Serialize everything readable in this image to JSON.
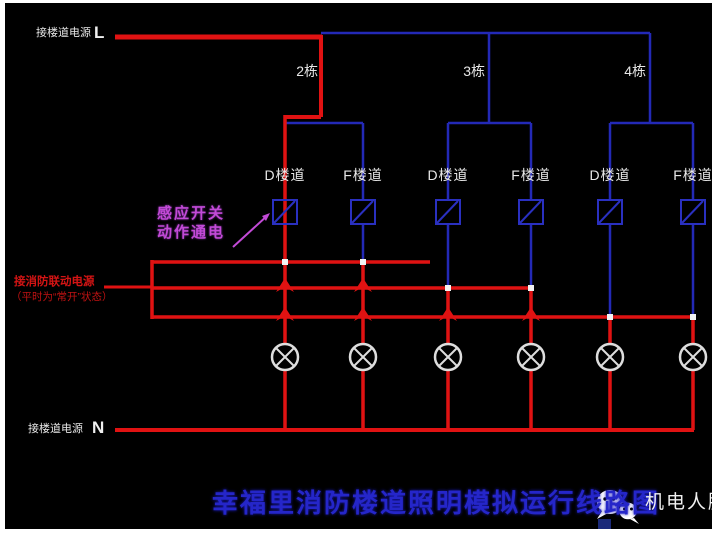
{
  "labels": {
    "top_supply": "接楼道电源",
    "live": "L",
    "neutral": "N",
    "bottom_supply": "接楼道电源",
    "buildings": [
      "2栋",
      "3栋",
      "4栋"
    ],
    "corridors": [
      "D楼道",
      "F楼道",
      "D楼道",
      "F楼道",
      "D楼道",
      "F楼道"
    ],
    "sensor_note": [
      "感应开关",
      "动作通电"
    ],
    "fire_supply": [
      "接消防联动电源",
      "（平时为“常开”状态）"
    ],
    "title": "幸福里消防楼道照明模拟运行线路图",
    "watermark": "机电人脉"
  },
  "colors": {
    "background": "#000000",
    "frame": "#ffffff",
    "wire_live": "#e01212",
    "wire_normal": "#2329b6",
    "lamp_outline": "#dddddd",
    "note_text": "#c24ad6",
    "fire_text": "#d41414",
    "title_text": "#2526c9",
    "label_text": "#e8e8e8"
  }
}
